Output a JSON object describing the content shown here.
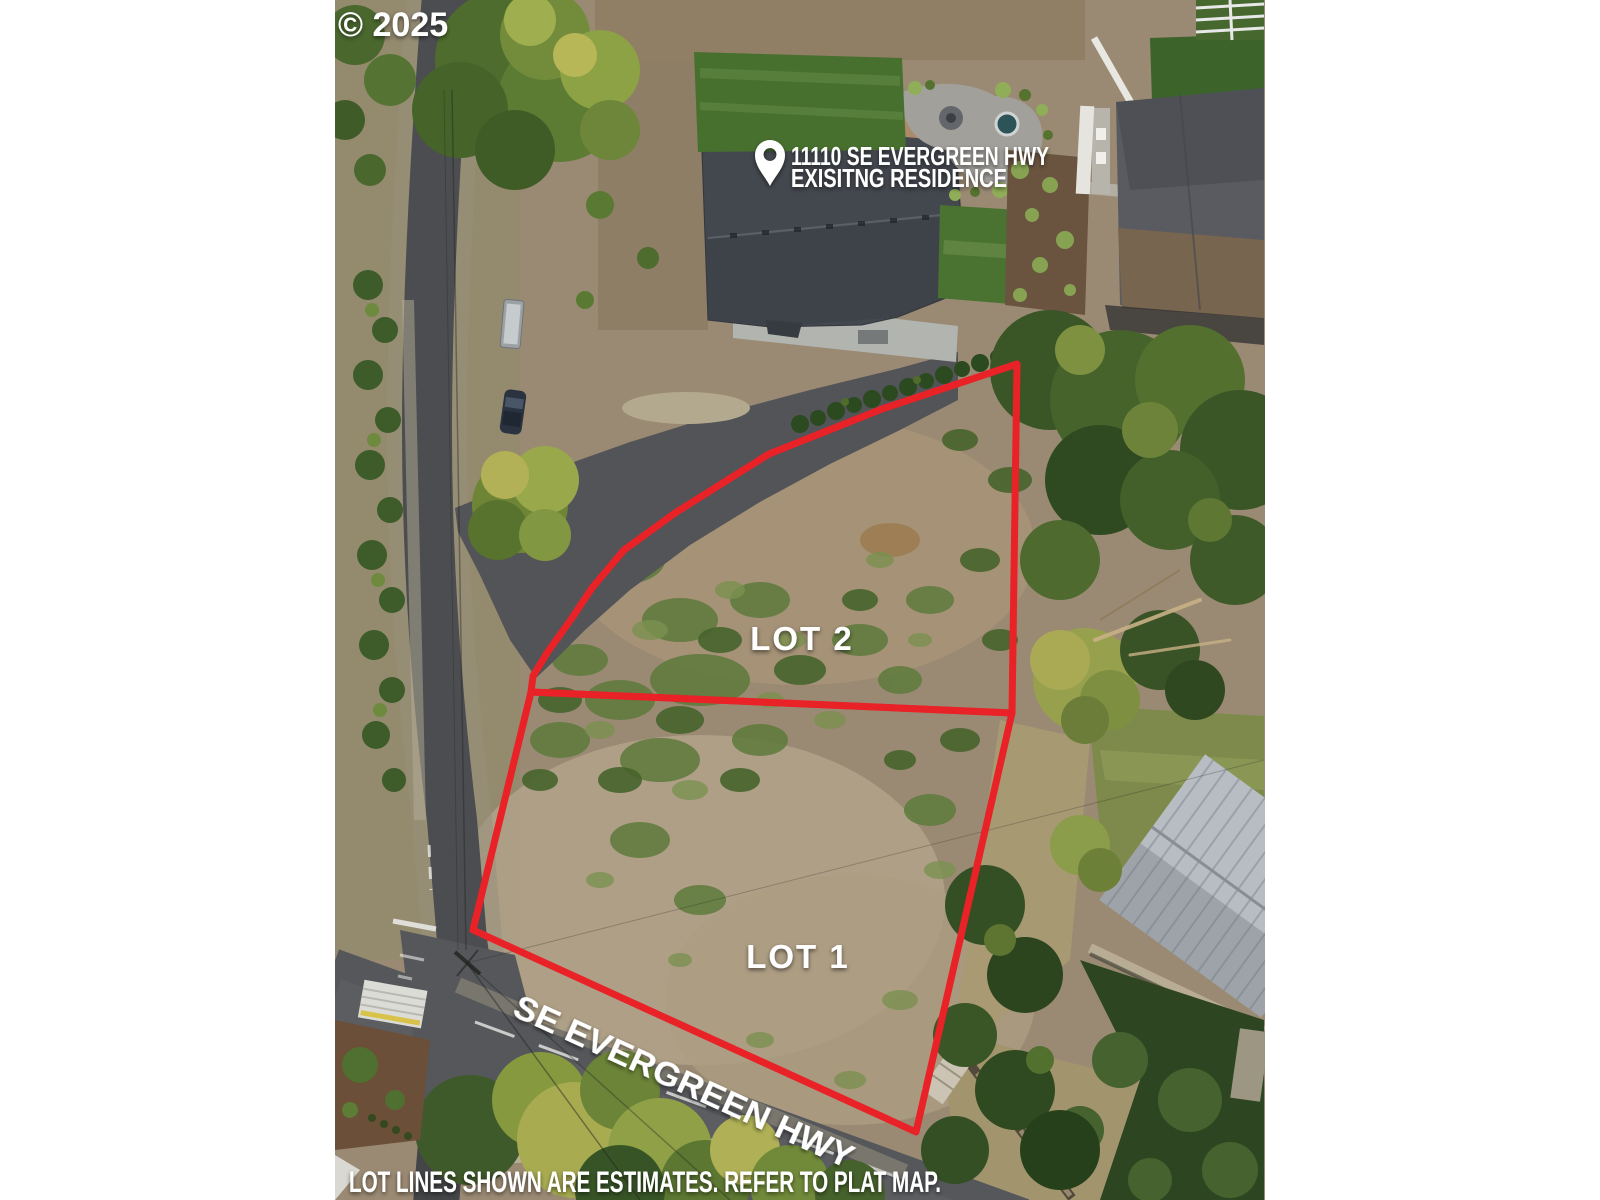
{
  "watermark": {
    "label": "© 2025"
  },
  "location_pin": {
    "line1": "11110 SE EVERGREEN HWY",
    "line2": "EXISITNG RESIDENCE"
  },
  "lots": [
    {
      "label": "LOT 2",
      "points": "1017,364 1012,713 531,692 533,676 547,653 572,618 592,588 624,550 675,513 769,454 882,409"
    },
    {
      "label": "LOT 1",
      "points": "531,692 1012,713 916,1132 473,930"
    }
  ],
  "road": {
    "label": "SE EVERGREEN HWY"
  },
  "disclaimer": {
    "label": "LOT LINES SHOWN ARE ESTIMATES. REFER TO PLAT MAP."
  },
  "colors": {
    "lot_line": "#e92227",
    "overlay_text": "#ffffff"
  }
}
